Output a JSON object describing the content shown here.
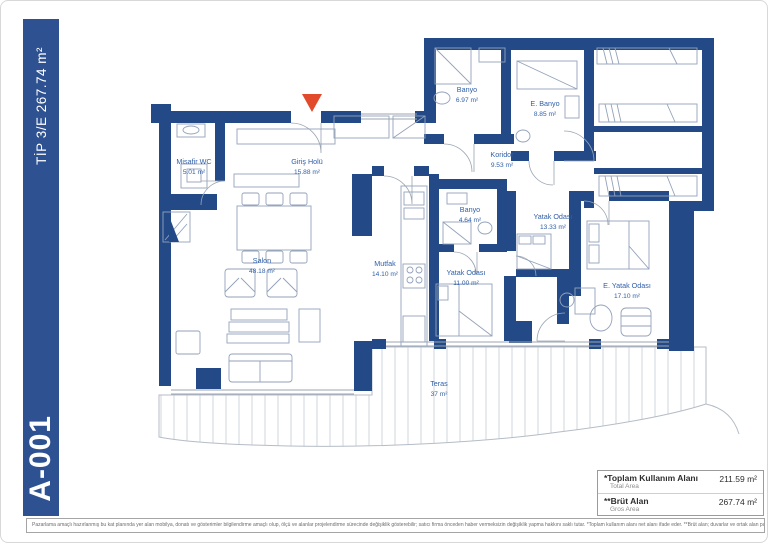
{
  "sidebar": {
    "type_label": "TİP 3/E 267.74 m²",
    "unit_code": "A-001"
  },
  "plan": {
    "rooms": [
      {
        "name": "Misafir WC",
        "area": "5.01 m²"
      },
      {
        "name": "Giriş Holü",
        "area": "15.88 m²"
      },
      {
        "name": "Banyo",
        "area": "6.97 m²"
      },
      {
        "name": "E. Banyo",
        "area": "8.85 m²"
      },
      {
        "name": "Koridor",
        "area": "9.53 m²"
      },
      {
        "name": "Banyo",
        "area": "4.64 m²"
      },
      {
        "name": "Yatak Odası",
        "area": "13.33 m²"
      },
      {
        "name": "Mutfak",
        "area": "14.10 m²"
      },
      {
        "name": "Salon",
        "area": "48.18 m²"
      },
      {
        "name": "Yatak Odası",
        "area": "11.00 m²"
      },
      {
        "name": "E. Yatak Odası",
        "area": "17.10 m²"
      },
      {
        "name": "Teras",
        "area": "37 m²"
      }
    ]
  },
  "summary_table": {
    "rows": [
      {
        "label": "*Toplam Kullanım Alanı",
        "sublabel": "Total Area",
        "value": "211.59 m²"
      },
      {
        "label": "**Brüt Alan",
        "sublabel": "Gros Area",
        "value": "267.74 m²"
      }
    ]
  },
  "disclaimer": "Pazarlama amaçlı hazırlanmış bu kat planında yer alan mobilya, donatı ve gösterimler bilgilendirme amaçlı olup, ölçü ve alanlar projelendirme sürecinde değişiklik gösterebilir; satıcı firma önceden haber vermeksizin değişiklik yapma hakkını saklı tutar. *Toplam kullanım alanı net alanı ifade eder. **Brüt alan; duvarlar ve ortak alan payları dahil toplam alanı ifade eder.",
  "colors": {
    "wall_navy": "#234a87",
    "sidebar_blue": "#2d5191",
    "label_blue": "#2f5fa8",
    "furn_gray": "#93a2ba",
    "entrance_red": "#e14a2b"
  }
}
